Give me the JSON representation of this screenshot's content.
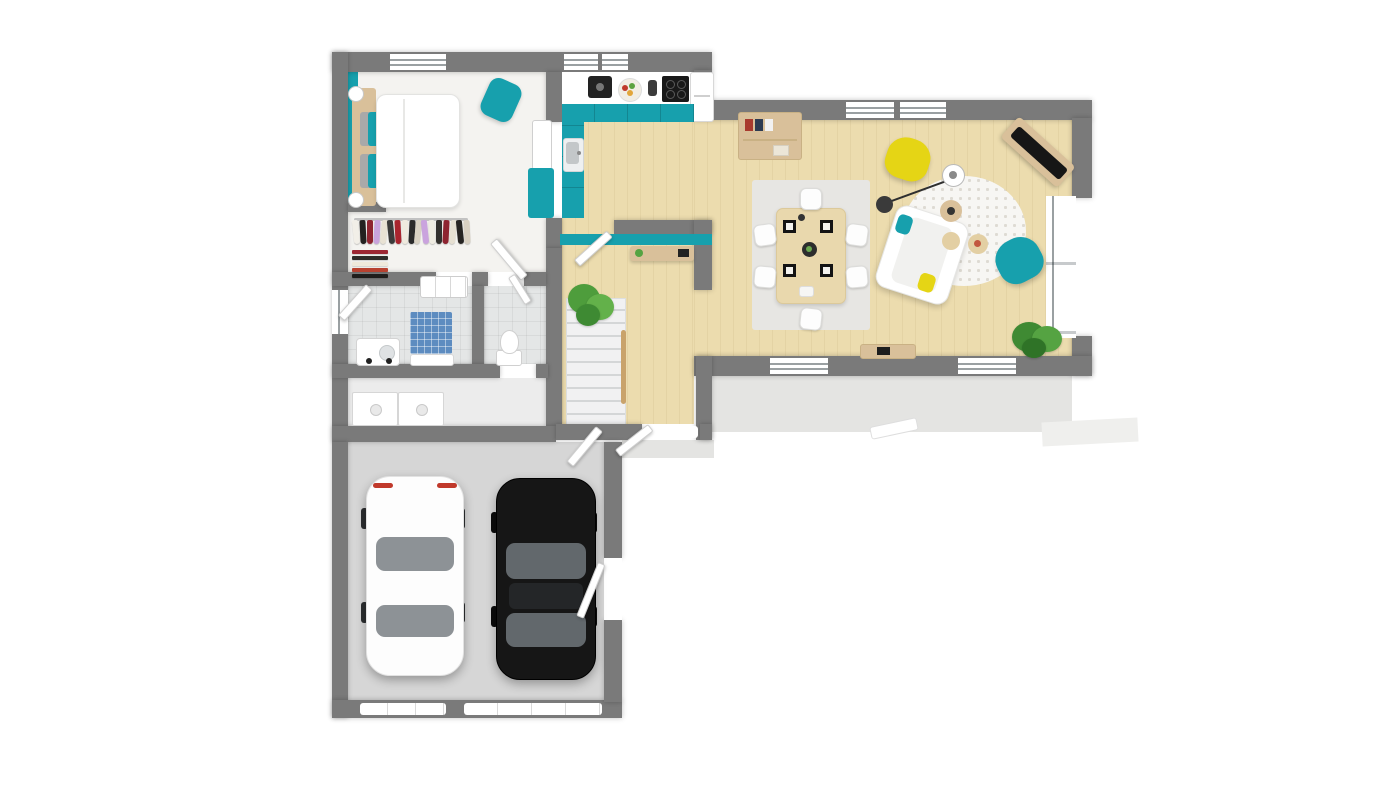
{
  "scene": {
    "title": "3d-floor-plan-top-view",
    "description": "L-shaped single storey house 3D floor plan with double garage",
    "background": "#ffffff"
  },
  "colors": {
    "wall": "#7a7a7a",
    "teal": "#17a0ad",
    "yellow": "#e5d515",
    "wood_floor": "#ecdcae",
    "white_floor": "#f4f3f0",
    "tile_floor": "#e4e6e6",
    "laundry_floor": "#ececec",
    "garage_floor": "#d6d6d6",
    "terrace": "#e4e4e2",
    "path": "#efefed",
    "stairs": "#f1f1f2",
    "stair_rail_wood": "#c9a36b",
    "wood_furniture": "#d9c09a",
    "table_wood": "#e9d8ad",
    "rug_gray": "#e7e6e3",
    "rug_white": "#f7f6f3",
    "mosaic_blue": "#5d8cc0",
    "basin_gray": "#c3c7c9",
    "appliance_dark": "#222222",
    "cooktop_black": "#191919",
    "plant_green": "#55a342",
    "pillow_gray": "#a9a9a9",
    "white": "#ffffff",
    "taillight_red": "#c0392b"
  },
  "rooms": [
    {
      "name": "bedroom",
      "features": [
        "double-bed",
        "wood-headboard",
        "two-ball-lamps",
        "gray-and-teal-pillows",
        "teal-accent-wall",
        "teal-ottoman",
        "shelf-unit",
        "teal-cabinet"
      ]
    },
    {
      "name": "dressing-room",
      "features": [
        "clothes-rail",
        "folded-clothes-stack",
        "drawer-dresser"
      ]
    },
    {
      "name": "bathroom",
      "features": [
        "blue-mosaic-shower",
        "vanity-sink"
      ]
    },
    {
      "name": "wc",
      "features": [
        "toilet"
      ]
    },
    {
      "name": "laundry-room",
      "features": [
        "washer",
        "dryer"
      ]
    },
    {
      "name": "garage",
      "features": [
        "white-car",
        "black-car",
        "two-garage-doors",
        "side-service-door"
      ]
    },
    {
      "name": "kitchen",
      "features": [
        "teal-cabinets",
        "coffee-machine",
        "fruit-bowl",
        "grinder",
        "cooktop",
        "fridge",
        "sink"
      ]
    },
    {
      "name": "entry-hall",
      "features": [
        "staircase",
        "wood-railing",
        "potted-plant",
        "teal-desk-nook",
        "laptop",
        "front-door"
      ]
    },
    {
      "name": "living-dining-room",
      "features": [
        "dining-table",
        "six-white-chairs",
        "four-placemats",
        "gray-rug",
        "bookshelf",
        "white-sofa",
        "teal-armchair",
        "yellow-armchair",
        "arc-floor-lamp",
        "round-patterned-rug",
        "wood-stools",
        "corner-tv-console",
        "tv",
        "sideboard",
        "potted-plant"
      ]
    },
    {
      "name": "terrace",
      "features": [
        "white-bench",
        "front-step",
        "garden-path"
      ]
    }
  ],
  "closet": {
    "garments": [
      "#f2efe8",
      "#23211f",
      "#8e2430",
      "#c9a4dd",
      "#e8e2d4",
      "#3a3a3a",
      "#a8242e",
      "#efeade",
      "#2b2b2b",
      "#d9d2c4",
      "#caa3de",
      "#efece2",
      "#32302d",
      "#8e2430",
      "#e6e0d2",
      "#262422",
      "#d8d0c2"
    ],
    "folded_stack": [
      "#9c2733",
      "#2e2c29",
      "#efe9db",
      "#b8412f",
      "#1f1d1b"
    ]
  },
  "cars": [
    {
      "name": "white-car",
      "body": "#fdfdfd",
      "glass": "#8d9296",
      "detail": "red-taillights"
    },
    {
      "name": "black-car",
      "body": "#161616",
      "glass": "#62686c",
      "detail": "gray-glass"
    }
  ],
  "dining": {
    "chairs": 6,
    "placemats": 4,
    "centerpiece": "dark-round-tray"
  },
  "openings": {
    "top_windows": 3,
    "living_top_windows": 2,
    "south_windows": 2,
    "bay_windows_right": 2,
    "bathroom_window": 1,
    "garage_doors": 2,
    "front_door": 1,
    "interior_doors": 6
  }
}
